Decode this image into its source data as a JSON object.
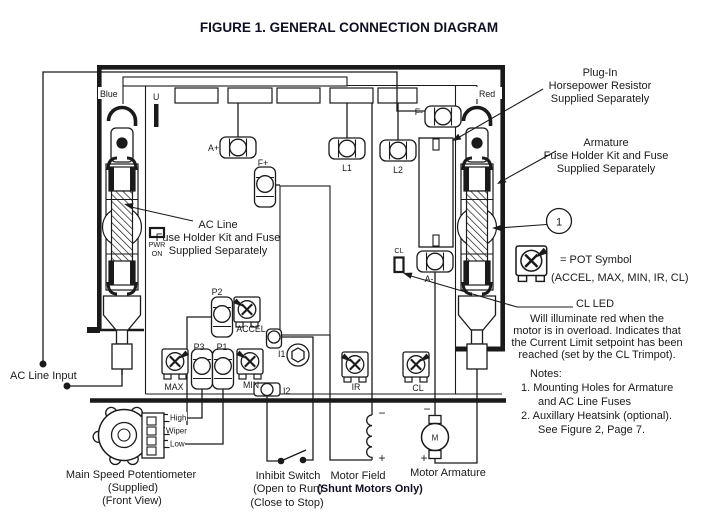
{
  "title": "FIGURE 1. GENERAL CONNECTION DIAGRAM",
  "colors": {
    "ink": "#1a1a1a",
    "bold_ink": "#0f0f23",
    "background": "#ffffff"
  },
  "board": {
    "lead_labels": {
      "blue": "Blue",
      "red": "Red"
    },
    "jumper_label": "U",
    "power_led": {
      "line1": "PWR",
      "line2": "ON"
    },
    "terminals": {
      "a_plus": "A+",
      "f_plus": "F+",
      "l1": "L1",
      "l2": "L2",
      "f_minus": "F-",
      "a_minus": "A-",
      "p2": "P2",
      "p3": "P3",
      "p1": "P1",
      "i1": "I1",
      "i2": "I2"
    },
    "trimpots": {
      "accel": "ACCEL",
      "max": "MAX",
      "min": "MIN",
      "ir": "IR",
      "cl": "CL"
    },
    "cl_led_label": "CL"
  },
  "callouts": {
    "ac_line_fuse": {
      "lines": [
        "AC Line",
        "Fuse Holder Kit and Fuse",
        "Supplied Separately"
      ]
    },
    "hp_resistor": {
      "lines": [
        "Plug-In",
        "Horsepower Resistor",
        "Supplied Separately"
      ]
    },
    "armature_fuse": {
      "lines": [
        "Armature",
        "Fuse Holder Kit and Fuse",
        "Supplied Separately"
      ]
    },
    "mounting_hole_ref": "1",
    "pot_legend": {
      "line1": "= POT Symbol",
      "line2": "(ACCEL, MAX, MIN, IR, CL)"
    },
    "cl_led": {
      "heading": "CL LED",
      "lines": [
        "Will illuminate red when the",
        "motor is in overload.  Indicates that",
        "the Current Limit setpoint has been",
        "reached (set by the CL Trimpot)."
      ]
    },
    "notes": {
      "heading": "Notes:",
      "note1": [
        "1. Mounting Holes for Armature",
        "and AC Line Fuses"
      ],
      "note2": [
        "2. Auxillary Heatsink (optional).",
        "See Figure 2, Page 7."
      ]
    }
  },
  "external": {
    "ac_line_input": "AC Line Input",
    "main_pot": {
      "caption": [
        "Main Speed Potentiometer",
        "(Supplied)",
        "(Front View)"
      ],
      "pins": [
        "High",
        "Wiper",
        "Low"
      ]
    },
    "inhibit_switch": {
      "caption": [
        "Inhibit Switch",
        "(Open to Run)",
        "(Close to Stop)"
      ]
    },
    "motor_field": {
      "caption": "Motor Field",
      "sub_caption": "(Shunt Motors Only)",
      "polarity_top": "−",
      "polarity_bottom": "+"
    },
    "motor_armature": {
      "caption": "Motor Armature",
      "motor_letter": "M",
      "polarity_top": "−",
      "polarity_bottom": "+"
    }
  }
}
